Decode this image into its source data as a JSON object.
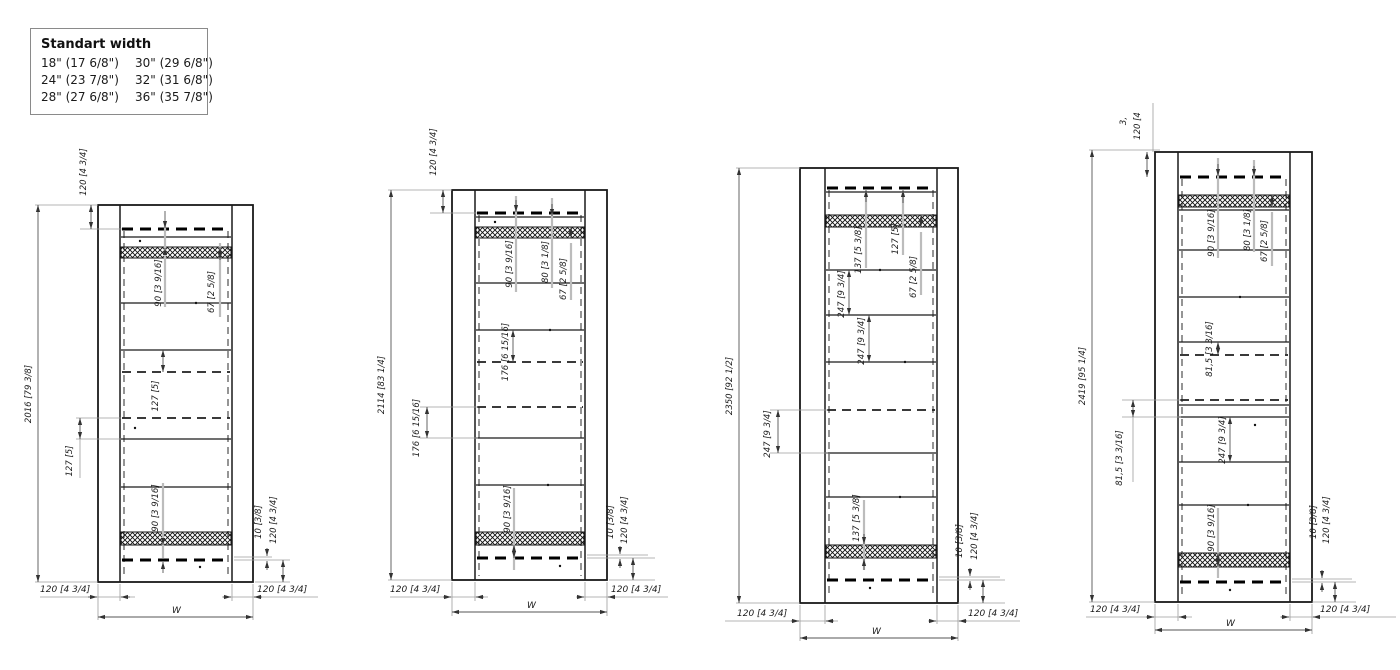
{
  "legend": {
    "title": "Standart width",
    "rows": [
      [
        "18\" (17 6/8\")",
        "30\" (29 6/8\")"
      ],
      [
        "24\" (23 7/8\")",
        "32\" (31 6/8\")"
      ],
      [
        "28\" (27 6/8\")",
        "36\" (35 7/8\")"
      ]
    ]
  },
  "drawings": [
    {
      "height": "2016 [79 3/8]",
      "top": "120 [4 3/4]",
      "inner": [
        "90 [3 9/16]",
        "67 [2 5/8]",
        "127 [5]",
        "127 [5]",
        "90 [3 9/16]"
      ],
      "right": [
        "10 [3/8]",
        "120 [4 3/4]"
      ],
      "bottom_left": "120 [4 3/4]",
      "bottom_right": "120 [4 3/4]",
      "width": "W"
    },
    {
      "height": "2114 [83 1/4]",
      "top": "120 [4 3/4]",
      "inner": [
        "90 [3 9/16]",
        "80 [3 1/8]",
        "67 [2 5/8]",
        "176 [6 15/16]",
        "176 [6 15/16]",
        "90 [3 9/16]"
      ],
      "right": [
        "10 [3/8]",
        "120 [4 3/4]"
      ],
      "bottom_left": "120 [4 3/4]",
      "bottom_right": "120 [4 3/4]",
      "width": "W"
    },
    {
      "height": "2350 [92 1/2]",
      "inner": [
        "137 [5 3/8]",
        "127 [5]",
        "67 [2 5/8]",
        "247 [9 3/4]",
        "247 [9 3/4]",
        "247 [9 3/4]",
        "137 [5 3/8]"
      ],
      "right": [
        "10 [3/8]",
        "120 [4 3/4]"
      ],
      "bottom_left": "120 [4 3/4]",
      "bottom_right": "120 [4 3/4]",
      "width": "W"
    },
    {
      "height": "2419 [95 1/4]",
      "top_clipped": [
        "3,",
        "120 [4"
      ],
      "inner": [
        "90 [3 9/16]",
        "80 [3 1/8]",
        "67 [2 5/8]",
        "81,5 [3 3/16]",
        "81,5 [3 3/16]",
        "247 [9 3/4]",
        "90 [3 9/16]"
      ],
      "right": [
        "10 [3/8]",
        "120 [4 3/4]"
      ],
      "bottom_left": "120 [4 3/4]",
      "bottom_right": "120 [4 3/4]",
      "width": "W"
    }
  ]
}
